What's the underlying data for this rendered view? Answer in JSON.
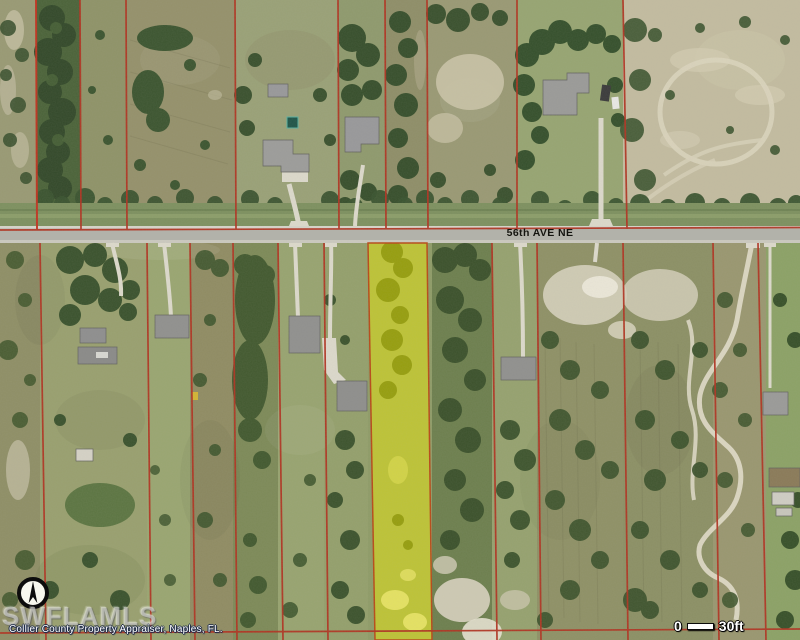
{
  "map_overlay": {
    "street_label": "56th AVE NE",
    "watermark": "SWFLAMLS",
    "attribution": "Collier County Property Appraiser, Naples, FL.",
    "scale_bar": {
      "start_label": "0",
      "end_label": "30ft"
    },
    "colors": {
      "parcel_line": "#b03422",
      "highlight_fill": "#f0ee00",
      "road": "#b2b2aa"
    }
  }
}
